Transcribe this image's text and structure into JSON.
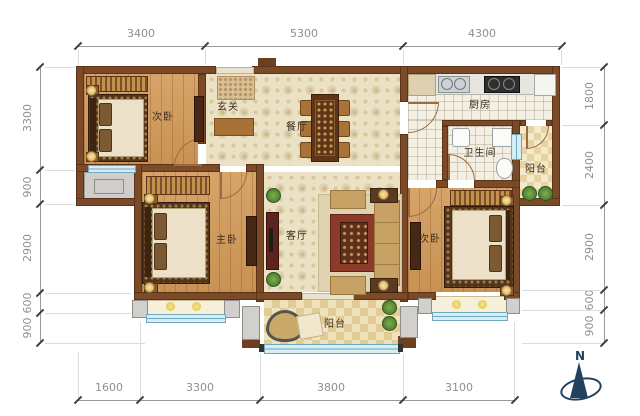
{
  "floorplan": {
    "compass": {
      "label": "N"
    },
    "rooms": [
      {
        "id": "bedroom-top-left",
        "label": "次卧"
      },
      {
        "id": "entry-hall",
        "label": "玄关"
      },
      {
        "id": "dining-room",
        "label": "餐厅"
      },
      {
        "id": "kitchen",
        "label": "厨房"
      },
      {
        "id": "bathroom",
        "label": "卫生间"
      },
      {
        "id": "balcony-east",
        "label": "阳台"
      },
      {
        "id": "master-bedroom",
        "label": "主卧"
      },
      {
        "id": "living-room",
        "label": "客厅"
      },
      {
        "id": "bedroom-bottom-right",
        "label": "次卧"
      },
      {
        "id": "balcony-south",
        "label": "阳台"
      }
    ],
    "dimensions_mm": {
      "top": [
        "3400",
        "5300",
        "4300"
      ],
      "bottom": [
        "1600",
        "3300",
        "3800",
        "3100"
      ],
      "left": [
        "3300",
        "900",
        "2900",
        "600",
        "900"
      ],
      "right": [
        "1800",
        "2400",
        "2900",
        "600",
        "900"
      ]
    },
    "icons": [
      "north-compass-icon",
      "bed-symbol",
      "sofa-symbol",
      "dining-table-symbol",
      "sink-symbol",
      "stove-symbol",
      "toilet-symbol",
      "plant-symbol",
      "door-swing-symbol"
    ],
    "colors": {
      "wall": "#7b4a28",
      "wood_floor": "#d29a58",
      "tile_floor": "#ebe1c4",
      "window": "#d6edf4",
      "window_frame": "#6fa8bd",
      "equipment_platform": "#cfcecb",
      "dimension_text": "#8f8f8f",
      "room_label_text": "#3e2e1e",
      "compass": "#23415f"
    }
  }
}
